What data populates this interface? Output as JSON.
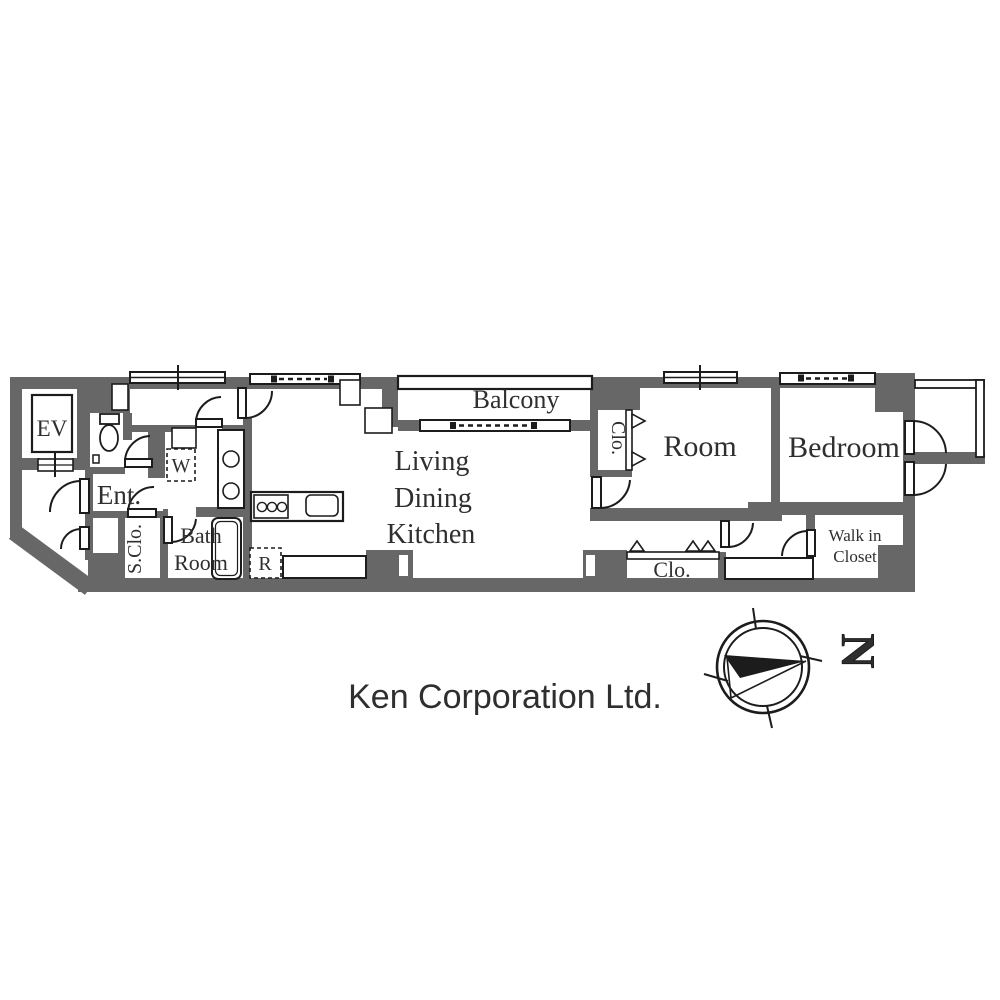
{
  "colors": {
    "wall": "#676767",
    "line": "#1c1c1c",
    "text": "#2f2f2f",
    "watermark": "#e9e9e9"
  },
  "labels": {
    "ev": "EV",
    "entrance": "Ent.",
    "shoe_closet": "S.Clo.",
    "bath": [
      "Bath",
      "Room"
    ],
    "washer": "W",
    "refrigerator": "R",
    "ldk": [
      "Living",
      "Dining",
      "Kitchen"
    ],
    "balcony": "Balcony",
    "closet_mid": "Clo.",
    "room": "Room",
    "bedroom": "Bedroom",
    "walk_in_closet": [
      "Walk in",
      "Closet"
    ],
    "closet_bottom": "Clo."
  },
  "compass": {
    "letter": "N"
  },
  "watermark": {
    "text": "Ken Corporation Ltd."
  }
}
